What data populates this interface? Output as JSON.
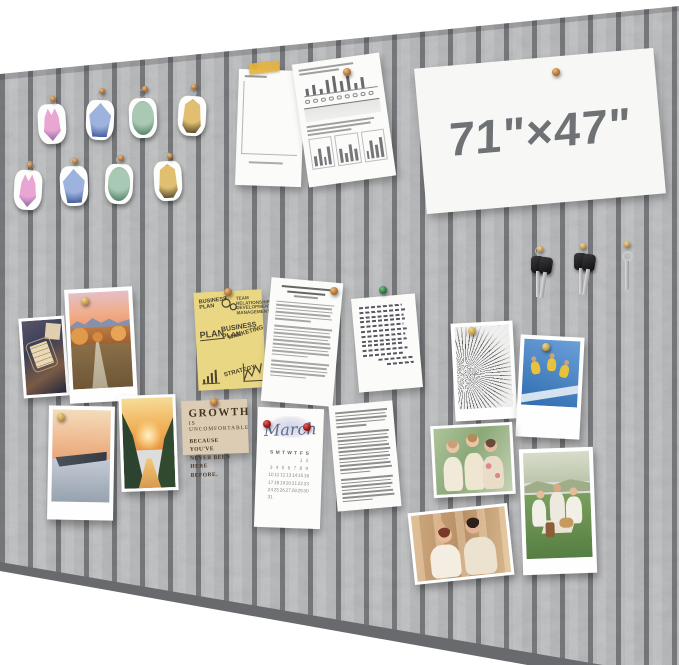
{
  "board": {
    "size_label": "71\"×47\"",
    "felt_color": "#c7c8ca",
    "groove_color": "#7e8083",
    "wall_color": "#ffffff",
    "description": "gray felt acoustic slat pin board"
  },
  "pins": {
    "bronze": "#b5763b",
    "gold": "#c9a24b",
    "red": "#a01818",
    "green": "#2f7a46"
  },
  "badges": {
    "items": [
      {
        "type": "cat",
        "main": "#e9a6d3",
        "dark": "#7a569e"
      },
      {
        "type": "crest",
        "main": "#9db3dd",
        "dark": "#2f4b8f"
      },
      {
        "type": "oval",
        "main": "#a9c9b4",
        "dark": "#3f7258"
      },
      {
        "type": "bell",
        "main": "#e0c070",
        "dark": "#38321f"
      },
      {
        "type": "cat",
        "main": "#e9a6d3",
        "dark": "#7a569e"
      },
      {
        "type": "crest",
        "main": "#9db3dd",
        "dark": "#2f4b8f"
      },
      {
        "type": "oval",
        "main": "#a9c9b4",
        "dark": "#3f7258"
      },
      {
        "type": "bell",
        "main": "#e0c070",
        "dark": "#38321f"
      }
    ]
  },
  "keys": {
    "sets": [
      {
        "style": "black-pair"
      },
      {
        "style": "black-pair"
      },
      {
        "style": "silver-single"
      }
    ]
  },
  "chart_data": {
    "type": "bar",
    "title": "pinned stacked bar chart (paper)",
    "stacked_series": [
      {
        "name": "bottom-red",
        "color": "#b85450",
        "values": [
          6,
          5,
          7,
          7,
          6,
          8,
          8,
          9,
          9,
          10,
          10,
          11,
          11,
          12,
          12,
          13,
          13,
          14,
          14,
          15,
          16,
          16,
          17,
          18
        ]
      },
      {
        "name": "middle-gray",
        "color": "#555a60",
        "values": [
          4,
          4,
          5,
          6,
          5,
          6,
          7,
          7,
          7,
          8,
          8,
          9,
          9,
          10,
          10,
          11,
          12,
          12,
          13,
          14,
          15,
          16,
          17,
          18
        ]
      },
      {
        "name": "top-blue",
        "color": "#a9c7e4",
        "values": [
          3,
          3,
          4,
          5,
          4,
          6,
          6,
          7,
          6,
          8,
          8,
          9,
          10,
          11,
          10,
          12,
          14,
          13,
          15,
          17,
          19,
          21,
          23,
          25
        ]
      }
    ]
  },
  "stats_sheet": {
    "top_line_widths": [
      72,
      52
    ],
    "top_bars": [
      35,
      55,
      25,
      70,
      85,
      55,
      78,
      30,
      60
    ],
    "circle_count": 9,
    "text_line_widths": [
      90,
      84,
      58
    ],
    "panels": [
      [
        40,
        65,
        30,
        70
      ],
      [
        55,
        35,
        68,
        45
      ],
      [
        32,
        72,
        50,
        80
      ]
    ]
  },
  "abstract_doc": {
    "title_line_widths": [
      86,
      64
    ],
    "byline_width": 42,
    "paragraph_line_counts": [
      6,
      9,
      5
    ]
  },
  "dense_doc": {
    "paragraph_line_counts": [
      5,
      12,
      7
    ]
  },
  "letter": {
    "line_widths": [
      85,
      92,
      88,
      90,
      86,
      91,
      87,
      89,
      84,
      90,
      80,
      70,
      55
    ]
  },
  "yellow_note": {
    "tl": "BUSINESS PLAN",
    "tr": "TEAM RELATIONSHIP DEVELOPMENT MANAGEMENT",
    "ml": "PLAN",
    "mc": "BUSINESS PLAN",
    "mr": "MARKETING",
    "bc": "STRATEGY"
  },
  "growth_card": {
    "line1": "GROWTH",
    "line2": "IS UNCOMFORTABLE",
    "line3": "BECAUSE YOU'VE",
    "line4": "NEVER BEEN HERE",
    "line5": "BEFORE."
  },
  "calendar": {
    "title": "March",
    "weekdays": [
      "S",
      "M",
      "T",
      "W",
      "T",
      "F",
      "S"
    ],
    "weeks": [
      [
        "",
        "",
        "",
        "",
        "",
        "1",
        "2"
      ],
      [
        "3",
        "4",
        "5",
        "6",
        "7",
        "8",
        "9"
      ],
      [
        "10",
        "11",
        "12",
        "13",
        "14",
        "15",
        "16"
      ],
      [
        "17",
        "18",
        "19",
        "20",
        "21",
        "22",
        "23"
      ],
      [
        "24",
        "25",
        "26",
        "27",
        "28",
        "29",
        "30"
      ],
      [
        "31",
        "",
        "",
        "",
        "",
        "",
        ""
      ]
    ]
  }
}
